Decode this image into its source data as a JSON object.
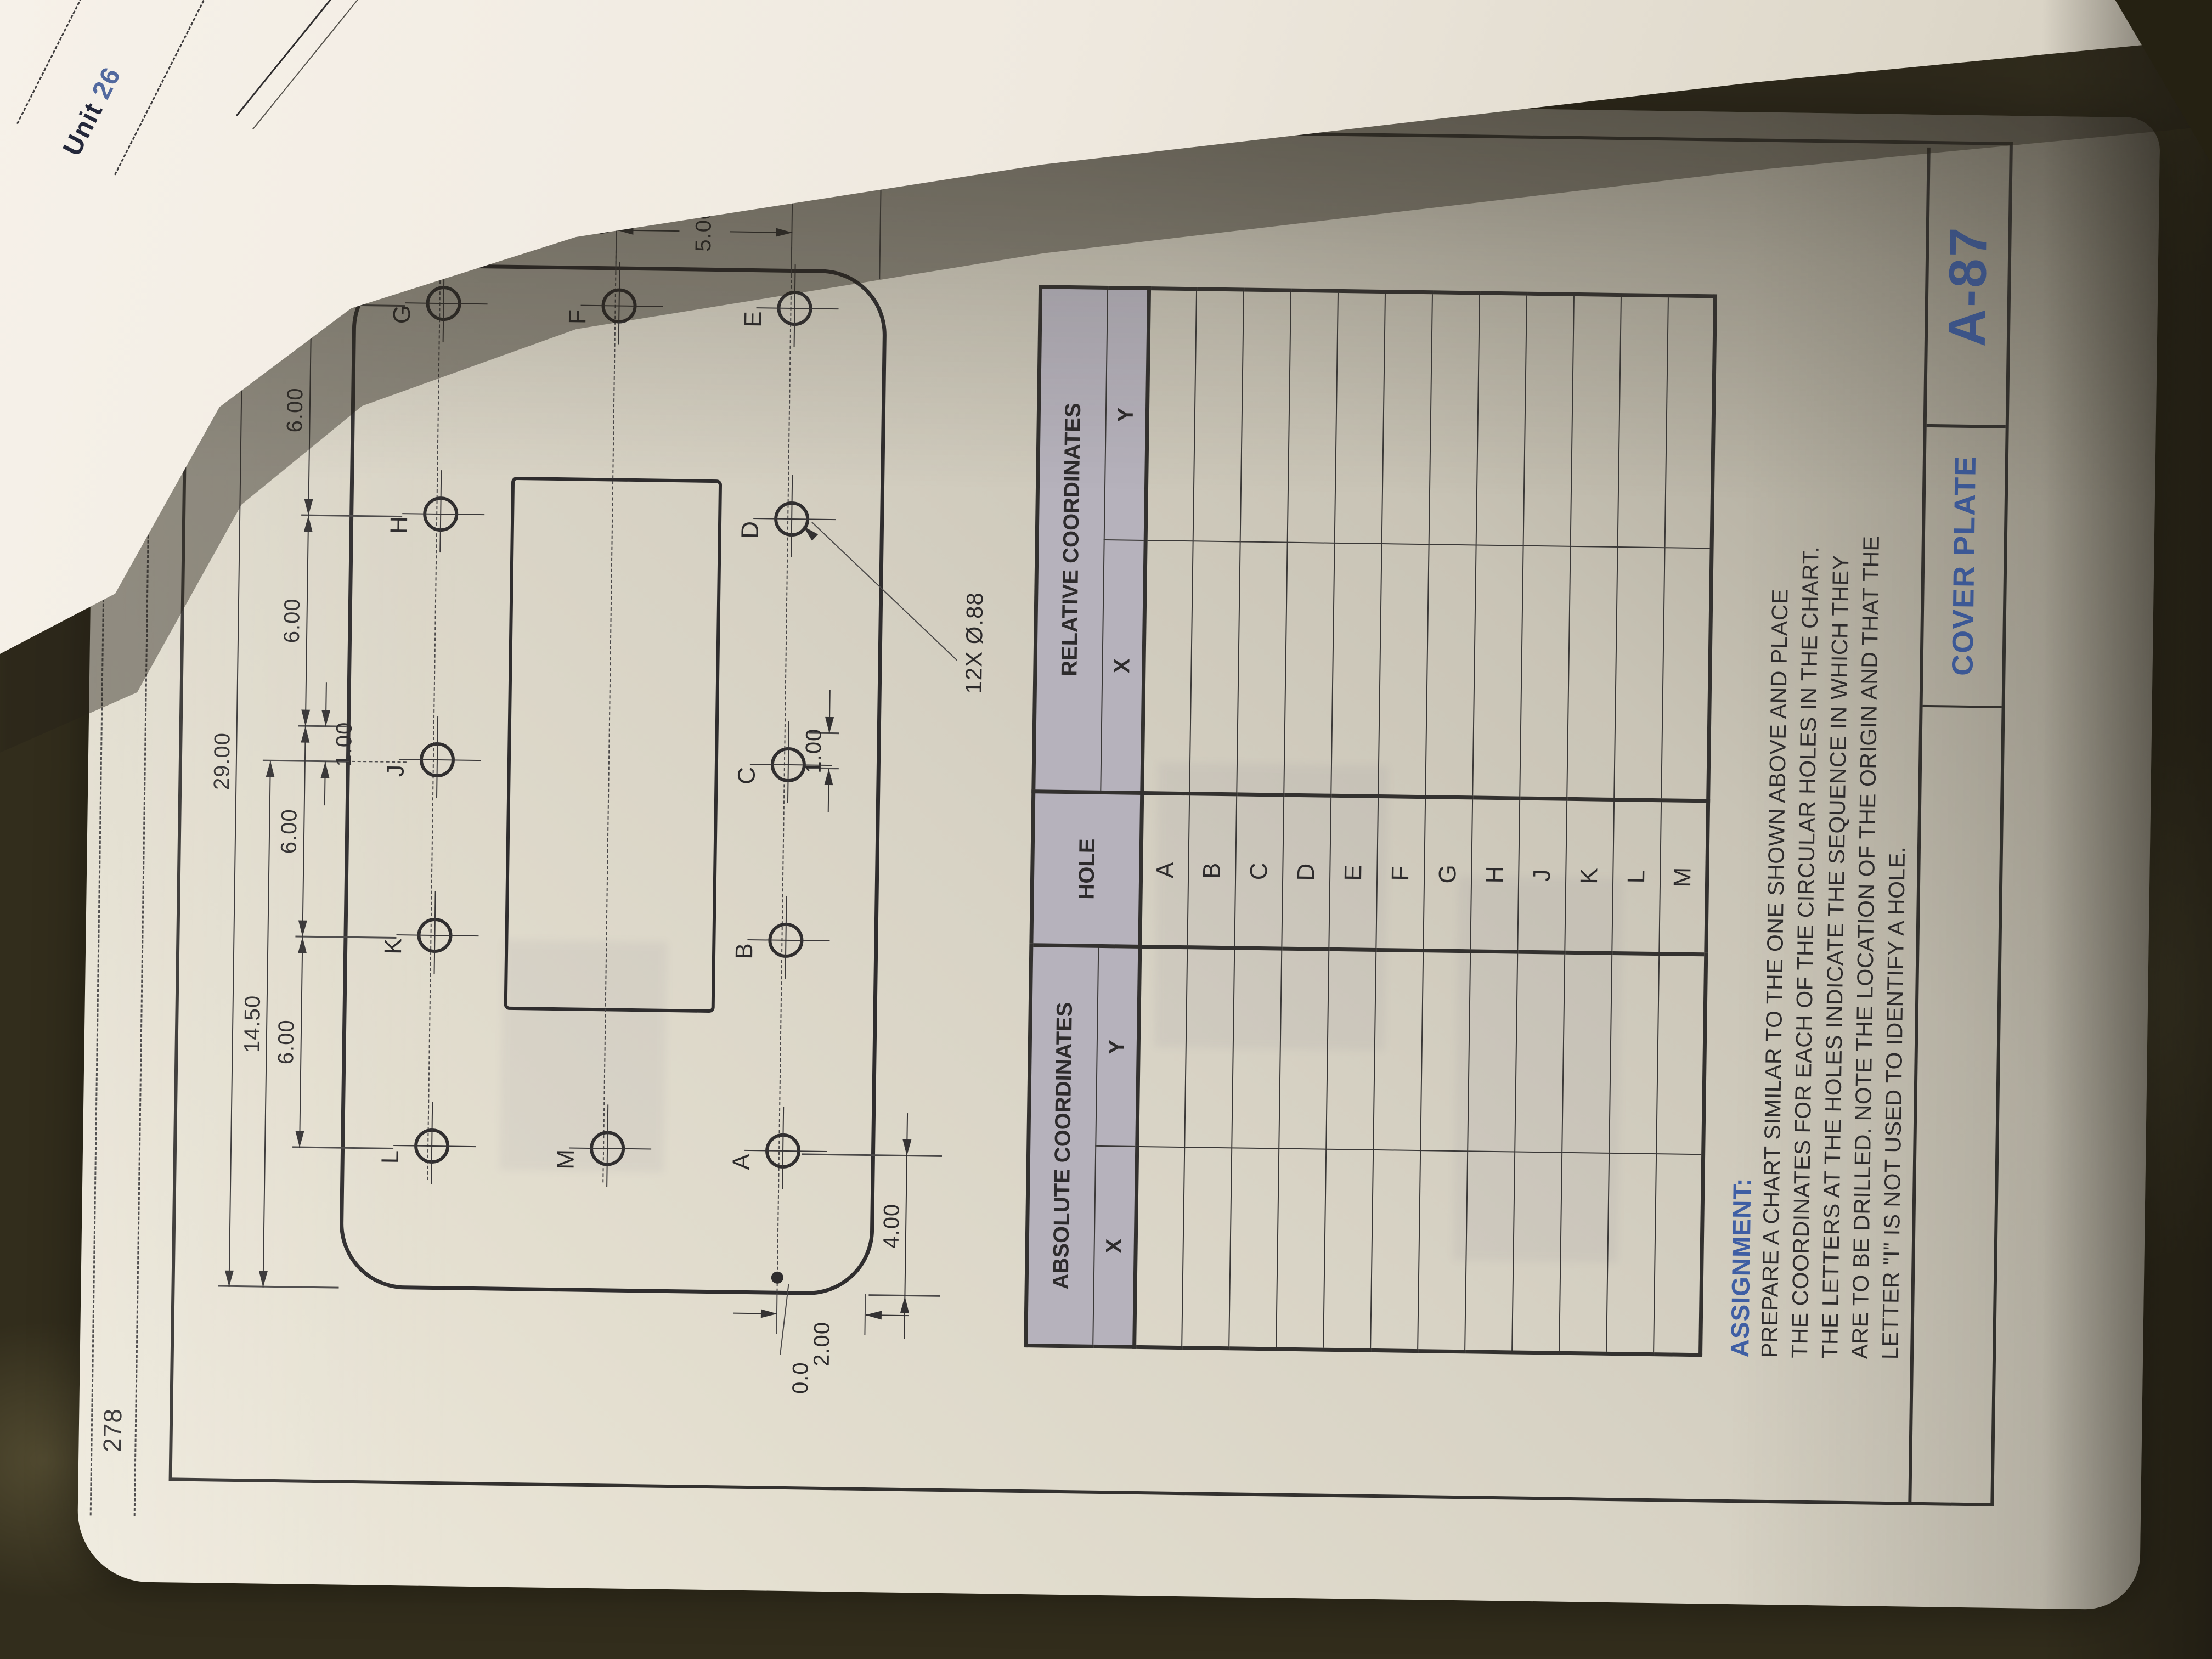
{
  "page": {
    "number": "278",
    "book_title": "Interpreting Engineering Drawings"
  },
  "facing_page": {
    "unit_word": "Unit",
    "unit_number": "26"
  },
  "drawing": {
    "holes": [
      "L",
      "K",
      "J",
      "H",
      "G",
      "M",
      "F",
      "A",
      "B",
      "C",
      "D",
      "E"
    ],
    "dims": {
      "overall_width": "29.00",
      "left_to_j": "14.50",
      "chain": [
        "6.00",
        "6.00",
        "6.00",
        "6.00"
      ],
      "offset_top": "1.00",
      "offset_bottom": "1.00",
      "overall_height": "15.00",
      "f_to_bottom": "7.50",
      "g_to_f": "5.00",
      "f_to_e": "5.00",
      "left_to_a": "4.00",
      "bottom_to_row": "2.00",
      "origin": "0.0",
      "hole_note": "12X Ø.88"
    }
  },
  "table": {
    "headers": {
      "absolute": "ABSOLUTE COORDINATES",
      "relative": "RELATIVE COORDINATES",
      "hole": "HOLE",
      "x": "X",
      "y": "Y"
    },
    "rows": [
      {
        "hole": "A"
      },
      {
        "hole": "B"
      },
      {
        "hole": "C"
      },
      {
        "hole": "D"
      },
      {
        "hole": "E"
      },
      {
        "hole": "F"
      },
      {
        "hole": "G"
      },
      {
        "hole": "H"
      },
      {
        "hole": "J"
      },
      {
        "hole": "K"
      },
      {
        "hole": "L"
      },
      {
        "hole": "M"
      }
    ]
  },
  "assignment": {
    "title": "ASSIGNMENT:",
    "lines": [
      "PREPARE A CHART SIMILAR TO THE ONE SHOWN ABOVE AND PLACE",
      "THE COORDINATES FOR EACH OF THE CIRCULAR HOLES IN THE CHART.",
      "THE LETTERS AT THE HOLES INDICATE THE SEQUENCE IN WHICH THEY",
      "ARE TO BE DRILLED. NOTE THE LOCATION OF THE ORIGIN AND THAT THE",
      "LETTER \"I\" IS NOT USED TO IDENTIFY A HOLE."
    ]
  },
  "title_block": {
    "title": "COVER PLATE",
    "number": "A-87"
  },
  "colors": {
    "accent_blue": "#3f5fa5",
    "paper": "#d9d4c8",
    "header_shade": "#b6b2bc",
    "carpet": "#322d1c"
  }
}
